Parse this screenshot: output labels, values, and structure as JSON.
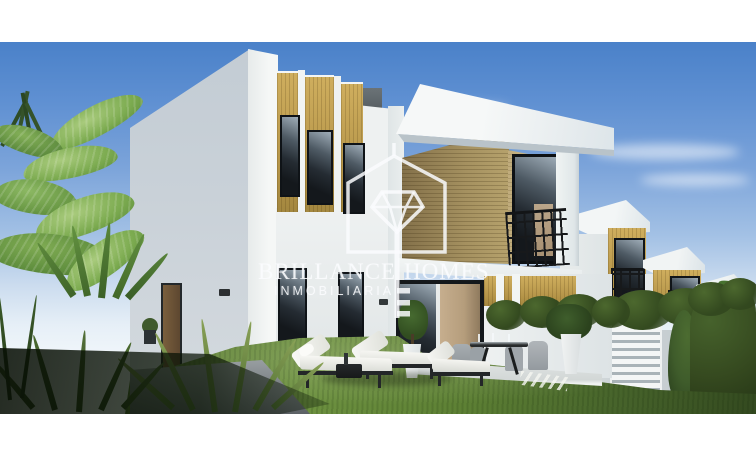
{
  "watermark": {
    "brand_left": "BRILLANCE",
    "brand_right": "HOMES",
    "subtitle": "INMOBILIARIA",
    "logo_icon": "house-diamond-key-icon",
    "color": "#ffffff"
  },
  "scene": {
    "type": "real-estate-3d-render",
    "subject": "modern two-storey white villas with wood cladding, garden lawn, terrace, sun loungers and tropical plants under a clear blue sky"
  },
  "palette": {
    "sky_top": "#4a81c9",
    "sky_horizon": "#f2f7fb",
    "villa_white": "#f1f4f3",
    "villa_shadow_face": "#c7cfd6",
    "wood_cladding": "#b49448",
    "wood_dark": "#84714a",
    "window_glass": "#171b20",
    "lawn_green": "#5d8034",
    "hedge_green": "#3a5226",
    "letterbox": "#ffffff"
  }
}
